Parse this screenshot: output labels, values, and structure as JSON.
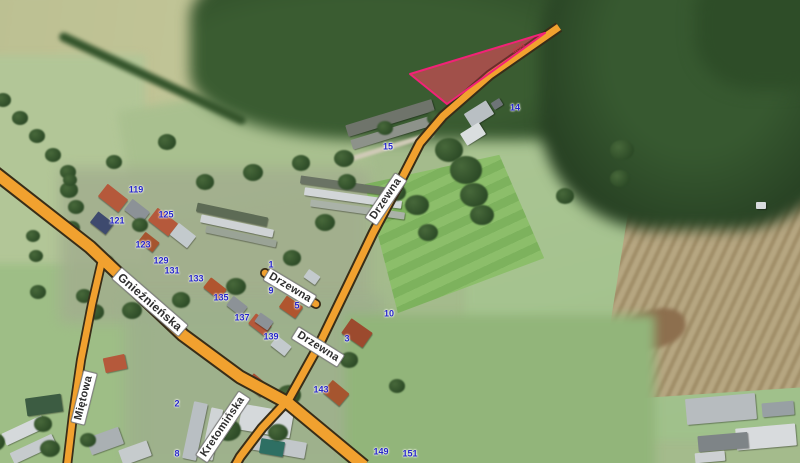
{
  "road_labels": [
    {
      "text": "Drzewna",
      "x": 386,
      "y": 199,
      "rot": -56,
      "major": false
    },
    {
      "text": "Drzewna",
      "x": 290,
      "y": 288,
      "rot": 31,
      "major": false
    },
    {
      "text": "Drzewna",
      "x": 318,
      "y": 347,
      "rot": 32,
      "major": false
    },
    {
      "text": "Gnieźnieńska",
      "x": 150,
      "y": 302,
      "rot": 41,
      "major": true
    },
    {
      "text": "Miętowa",
      "x": 84,
      "y": 398,
      "rot": -76,
      "major": false
    },
    {
      "text": "Kretomińska",
      "x": 223,
      "y": 427,
      "rot": -56,
      "major": false
    }
  ],
  "house_numbers": [
    {
      "text": "119",
      "x": 136,
      "y": 190
    },
    {
      "text": "121",
      "x": 117,
      "y": 221
    },
    {
      "text": "125",
      "x": 166,
      "y": 215
    },
    {
      "text": "123",
      "x": 143,
      "y": 245
    },
    {
      "text": "129",
      "x": 161,
      "y": 261
    },
    {
      "text": "131",
      "x": 172,
      "y": 271
    },
    {
      "text": "133",
      "x": 196,
      "y": 279
    },
    {
      "text": "135",
      "x": 221,
      "y": 298
    },
    {
      "text": "137",
      "x": 242,
      "y": 318
    },
    {
      "text": "139",
      "x": 271,
      "y": 337
    },
    {
      "text": "143",
      "x": 321,
      "y": 390
    },
    {
      "text": "149",
      "x": 381,
      "y": 452
    },
    {
      "text": "151",
      "x": 410,
      "y": 454
    },
    {
      "text": "1",
      "x": 271,
      "y": 265
    },
    {
      "text": "9",
      "x": 271,
      "y": 291
    },
    {
      "text": "5",
      "x": 297,
      "y": 306
    },
    {
      "text": "3",
      "x": 347,
      "y": 339
    },
    {
      "text": "15",
      "x": 388,
      "y": 147
    },
    {
      "text": "14",
      "x": 515,
      "y": 108
    },
    {
      "text": "10",
      "x": 389,
      "y": 314
    },
    {
      "text": "2",
      "x": 177,
      "y": 404
    },
    {
      "text": "8",
      "x": 177,
      "y": 454
    }
  ],
  "parcel": {
    "number": "40/4"
  },
  "colors": {
    "road_fill": "#f1a12f",
    "road_casing": "#382d18",
    "road_label_text": "#2f2f2f",
    "road_label_bg": "#ffffff",
    "house_number": "#2424c8",
    "parcel_outline": "#f22277",
    "parcel_fill": "rgba(226,48,92,0.30)",
    "parcel_dirt": "#8f5f45",
    "parcel_number": "#cf3148"
  }
}
